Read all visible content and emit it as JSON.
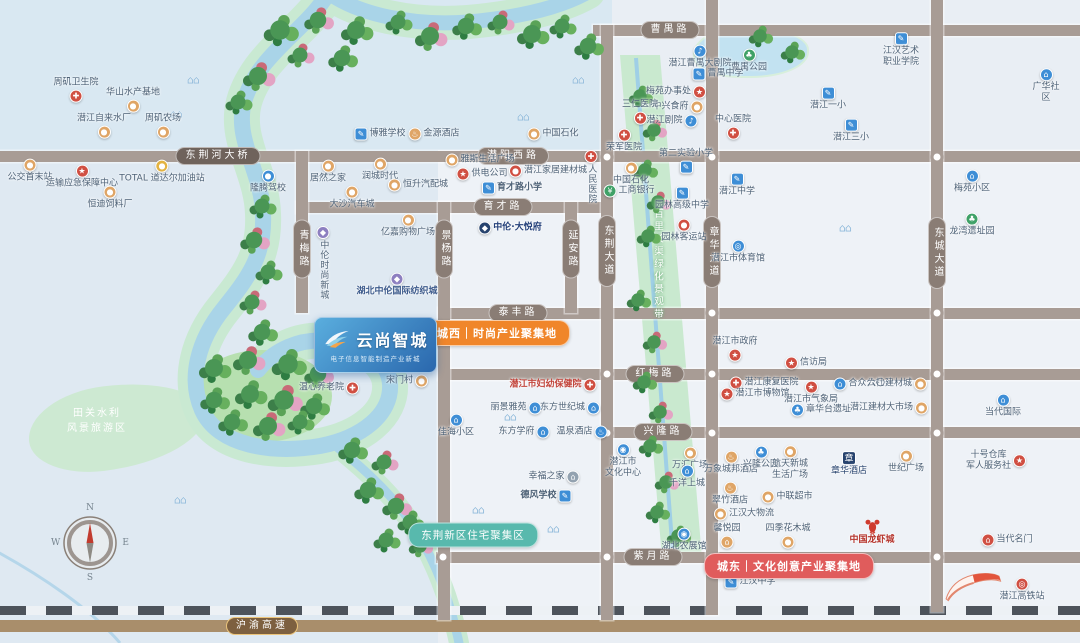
{
  "map": {
    "project": {
      "name": "云尚智城",
      "tagline": "电子信息智能制造产业新城"
    },
    "banners": {
      "west": "城西｜时尚产业聚集地",
      "east": "城东｜文化创意产业聚集地",
      "residential": "东荆新区住宅聚集区"
    },
    "areas": {
      "scenic": "田关水利\n风景旅游区",
      "greenway": "百里长渠绿化景观带"
    },
    "compass": {
      "n": "N",
      "e": "E",
      "s": "S",
      "w": "W"
    },
    "colors": {
      "ground": "#e9eef4",
      "water": "#d9e8f2",
      "block": "#eef2f7",
      "road": "#a89c95",
      "capsule": "#8a7d75",
      "river": "#a9d4e8",
      "greenway": "#c9e9cf",
      "west": "#f0862a",
      "east": "#e05c5c",
      "residential": "#58b9ad",
      "rail_dark": "#4d535b",
      "highway": "#a98e6b",
      "highway_capsule": "#7d6040",
      "gold": "#ecc57c"
    },
    "roads_h": [
      {
        "name": "曹禺路",
        "y": 25,
        "x1": 593,
        "x2": 1080,
        "lx": 670
      },
      {
        "name": "潜阳西路",
        "y": 151,
        "x1": 0,
        "x2": 1080,
        "lx": 513
      },
      {
        "name": "育才路",
        "y": 202,
        "x1": 296,
        "x2": 612,
        "lx": 503
      },
      {
        "name": "泰丰路",
        "y": 308,
        "x1": 438,
        "x2": 1080,
        "lx": 518
      },
      {
        "name": "红梅路",
        "y": 369,
        "x1": 438,
        "x2": 1080,
        "lx": 655
      },
      {
        "name": "兴隆路",
        "y": 427,
        "x1": 600,
        "x2": 1080,
        "lx": 663
      },
      {
        "name": "紫月路",
        "y": 552,
        "x1": 436,
        "x2": 1080,
        "lx": 653
      }
    ],
    "roads_v": [
      {
        "name": "青梅路",
        "x": 296,
        "y1": 151,
        "y2": 313,
        "ly": 249
      },
      {
        "name": "景杨路",
        "x": 438,
        "y1": 202,
        "y2": 620,
        "ly": 249
      },
      {
        "name": "延安路",
        "x": 565,
        "y1": 202,
        "y2": 313,
        "ly": 249
      },
      {
        "name": "东荆大道",
        "x": 601,
        "y1": 25,
        "y2": 620,
        "ly": 251
      },
      {
        "name": "章华大道",
        "x": 706,
        "y1": 0,
        "y2": 615,
        "ly": 252
      },
      {
        "name": "东城大道",
        "x": 931,
        "y1": 0,
        "y2": 612,
        "ly": 253
      }
    ],
    "extra_labels": [
      {
        "text": "东荆河大桥",
        "x": 218,
        "y": 156,
        "cls": "bridge"
      }
    ],
    "highway": {
      "name": "沪渝高速",
      "lx": 262,
      "ly": 626
    },
    "nodes": [
      [
        607,
        157
      ],
      [
        712,
        157
      ],
      [
        937,
        157
      ],
      [
        712,
        313
      ],
      [
        937,
        313
      ],
      [
        607,
        374
      ],
      [
        712,
        374
      ],
      [
        937,
        374
      ],
      [
        607,
        433
      ],
      [
        712,
        433
      ],
      [
        937,
        433
      ],
      [
        443,
        557
      ],
      [
        607,
        557
      ],
      [
        712,
        557
      ],
      [
        937,
        557
      ]
    ],
    "pois": [
      {
        "label": "周矶卫生院",
        "x": 76,
        "y": 90,
        "ic": "hospital",
        "c": "red",
        "ip": "bottom"
      },
      {
        "label": "华山水产基地",
        "x": 133,
        "y": 100,
        "ic": "shop",
        "c": "orange",
        "ip": "bottom"
      },
      {
        "label": "潜江自来水厂",
        "x": 104,
        "y": 126,
        "ic": "shop",
        "c": "orange",
        "ip": "bottom"
      },
      {
        "label": "周矶农场",
        "x": 163,
        "y": 126,
        "ic": "shop",
        "c": "orange",
        "ip": "bottom"
      },
      {
        "label": "公交首末站",
        "x": 30,
        "y": 171,
        "ic": "bus",
        "c": "orange",
        "ip": "top"
      },
      {
        "label": "运输应急保障中心",
        "x": 82,
        "y": 177,
        "ic": "gov",
        "c": "red",
        "ip": "top"
      },
      {
        "label": "恒迪饲料厂",
        "x": 110,
        "y": 198,
        "ic": "shop",
        "c": "orange",
        "ip": "top"
      },
      {
        "label": "TOTAL 道达尔加油站",
        "x": 162,
        "y": 172,
        "ic": "fuel",
        "c": "gold",
        "ip": "top"
      },
      {
        "label": "隆腾驾校",
        "x": 268,
        "y": 182,
        "ic": "car",
        "c": "blue",
        "ip": "top"
      },
      {
        "label": "博雅学校",
        "x": 380,
        "y": 134,
        "ic": "school",
        "c": "blue",
        "ip": "left"
      },
      {
        "label": "金源酒店",
        "x": 434,
        "y": 134,
        "ic": "hotel",
        "c": "orange",
        "ip": "left"
      },
      {
        "label": "中国石化",
        "x": 553,
        "y": 134,
        "ic": "fuel",
        "c": "orange",
        "ip": "left"
      },
      {
        "label": "居然之家",
        "x": 328,
        "y": 172,
        "ic": "shop",
        "c": "orange",
        "ip": "top"
      },
      {
        "label": "润城时代",
        "x": 380,
        "y": 170,
        "ic": "shop",
        "c": "orange",
        "ip": "top"
      },
      {
        "label": "恒升汽配城",
        "x": 418,
        "y": 185,
        "ic": "shop",
        "c": "orange",
        "ip": "left"
      },
      {
        "label": "大沙汽车城",
        "x": 352,
        "y": 198,
        "ic": "shop",
        "c": "orange",
        "ip": "top"
      },
      {
        "label": "雅斯生活广场",
        "x": 480,
        "y": 160,
        "ic": "shop",
        "c": "orange",
        "ip": "left"
      },
      {
        "label": "供电公司",
        "x": 482,
        "y": 174,
        "ic": "gov",
        "c": "red",
        "ip": "left"
      },
      {
        "label": "潜江家居建材城",
        "x": 548,
        "y": 171,
        "ic": "shop",
        "c": "red",
        "ip": "left"
      },
      {
        "label": "育才路小学",
        "x": 512,
        "y": 188,
        "ic": "school",
        "c": "blue",
        "ip": "left",
        "bold": true
      },
      {
        "label": "人民医院",
        "x": 591,
        "y": 177,
        "ic": "hospital",
        "c": "red",
        "ip": "top",
        "v": true
      },
      {
        "label": "中国石化",
        "x": 631,
        "y": 174,
        "ic": "fuel",
        "c": "orange",
        "ip": "top"
      },
      {
        "label": "工商银行",
        "x": 629,
        "y": 191,
        "ic": "bank",
        "c": "green",
        "ip": "left"
      },
      {
        "label": "中伦时尚新城",
        "x": 323,
        "y": 263,
        "ic": "brand",
        "c": "purple",
        "ip": "top",
        "v": true
      },
      {
        "label": "亿嘉购物广场",
        "x": 408,
        "y": 226,
        "ic": "shop",
        "c": "orange",
        "ip": "top"
      },
      {
        "label": "湖北中伦国际纺织城",
        "x": 397,
        "y": 285,
        "ic": "brand",
        "c": "purple",
        "ip": "top",
        "bold": true,
        "lc": "#3d5b8c"
      },
      {
        "label": "中伦·大悦府",
        "x": 510,
        "y": 228,
        "ic": "brandmark",
        "c": "navy",
        "ip": "left",
        "lc": "#24407a",
        "bold": true
      },
      {
        "label": "温心养老院",
        "x": 329,
        "y": 388,
        "ic": "hospital",
        "c": "red",
        "ip": "right"
      },
      {
        "label": "宋门村",
        "x": 407,
        "y": 381,
        "ic": "shop",
        "c": "orange",
        "ip": "right"
      },
      {
        "label": "潜江曹禺大剧院",
        "x": 700,
        "y": 57,
        "ic": "theater",
        "c": "blue",
        "ip": "top"
      },
      {
        "label": "曹禺公园",
        "x": 749,
        "y": 61,
        "ic": "park",
        "c": "green",
        "ip": "top"
      },
      {
        "label": "曹禺中学",
        "x": 718,
        "y": 74,
        "ic": "school",
        "c": "blue",
        "ip": "left"
      },
      {
        "label": "梅苑办事处",
        "x": 676,
        "y": 92,
        "ic": "gov",
        "c": "red",
        "ip": "right"
      },
      {
        "label": "中兴食府",
        "x": 678,
        "y": 107,
        "ic": "shop",
        "c": "orange",
        "ip": "right"
      },
      {
        "label": "潜江剧院",
        "x": 672,
        "y": 121,
        "ic": "theater",
        "c": "blue",
        "ip": "right"
      },
      {
        "label": "三仁医院",
        "x": 640,
        "y": 112,
        "ic": "hospital",
        "c": "red",
        "ip": "bottom"
      },
      {
        "label": "荣军医院",
        "x": 624,
        "y": 141,
        "ic": "hospital",
        "c": "red",
        "ip": "top"
      },
      {
        "label": "江汉艺术\n职业学院",
        "x": 901,
        "y": 50,
        "ic": "school",
        "c": "blue",
        "ip": "top"
      },
      {
        "label": "潜江一小",
        "x": 828,
        "y": 99,
        "ic": "school",
        "c": "blue",
        "ip": "top"
      },
      {
        "label": "潜江三小",
        "x": 851,
        "y": 131,
        "ic": "school",
        "c": "blue",
        "ip": "top"
      },
      {
        "label": "中心医院",
        "x": 733,
        "y": 127,
        "ic": "hospital",
        "c": "red",
        "ip": "bottom"
      },
      {
        "label": "广华社区",
        "x": 1046,
        "y": 86,
        "ic": "home",
        "c": "blue",
        "ip": "top"
      },
      {
        "label": "梅苑小区",
        "x": 972,
        "y": 182,
        "ic": "home",
        "c": "blue",
        "ip": "top"
      },
      {
        "label": "龙湾遗址园",
        "x": 972,
        "y": 225,
        "ic": "park",
        "c": "green",
        "ip": "top"
      },
      {
        "label": "第二实验小学",
        "x": 686,
        "y": 161,
        "ic": "school",
        "c": "blue",
        "ip": "bottom"
      },
      {
        "label": "潜江中学",
        "x": 737,
        "y": 185,
        "ic": "school",
        "c": "blue",
        "ip": "top"
      },
      {
        "label": "园林高级中学",
        "x": 682,
        "y": 199,
        "ic": "school",
        "c": "blue",
        "ip": "top"
      },
      {
        "label": "园林客运站",
        "x": 684,
        "y": 231,
        "ic": "bus",
        "c": "red",
        "ip": "top"
      },
      {
        "label": "潜江市体育馆",
        "x": 738,
        "y": 252,
        "ic": "stadium",
        "c": "blue",
        "ip": "top"
      },
      {
        "label": "潜江市政府",
        "x": 735,
        "y": 349,
        "ic": "gov",
        "c": "red",
        "ip": "bottom"
      },
      {
        "label": "信访局",
        "x": 806,
        "y": 363,
        "ic": "gov",
        "c": "red",
        "ip": "left"
      },
      {
        "label": "潜江康复医院",
        "x": 764,
        "y": 383,
        "ic": "hospital",
        "c": "red",
        "ip": "left"
      },
      {
        "label": "潜江市博物馆",
        "x": 755,
        "y": 394,
        "ic": "gov",
        "c": "red",
        "ip": "left"
      },
      {
        "label": "潜江市气象局",
        "x": 811,
        "y": 393,
        "ic": "gov",
        "c": "red",
        "ip": "top"
      },
      {
        "label": "合众公社",
        "x": 859,
        "y": 384,
        "ic": "home",
        "c": "blue",
        "ip": "left"
      },
      {
        "label": "六〇建材城",
        "x": 897,
        "y": 384,
        "ic": "shop",
        "c": "orange",
        "ip": "right"
      },
      {
        "label": "章华台遗址",
        "x": 821,
        "y": 410,
        "ic": "park",
        "c": "blue",
        "ip": "left"
      },
      {
        "label": "潜江建材大市场",
        "x": 889,
        "y": 408,
        "ic": "shop",
        "c": "orange",
        "ip": "right"
      },
      {
        "label": "潜江市妇幼保健院",
        "x": 553,
        "y": 385,
        "ic": "hospital",
        "c": "red",
        "ip": "right",
        "bold": true,
        "lc": "#c2453c"
      },
      {
        "label": "丽景雅苑",
        "x": 516,
        "y": 408,
        "ic": "home",
        "c": "blue",
        "ip": "right"
      },
      {
        "label": "东方世纪城",
        "x": 570,
        "y": 408,
        "ic": "home",
        "c": "blue",
        "ip": "right"
      },
      {
        "label": "佳海小区",
        "x": 456,
        "y": 426,
        "ic": "home",
        "c": "blue",
        "ip": "top"
      },
      {
        "label": "东方学府",
        "x": 524,
        "y": 432,
        "ic": "home",
        "c": "blue",
        "ip": "right"
      },
      {
        "label": "温泉酒店",
        "x": 582,
        "y": 432,
        "ic": "hotel",
        "c": "blue",
        "ip": "right"
      },
      {
        "label": "潜江市\n文化中心",
        "x": 623,
        "y": 461,
        "ic": "culture",
        "c": "blue",
        "ip": "top"
      },
      {
        "label": "幸福之家",
        "x": 554,
        "y": 477,
        "ic": "home",
        "c": "gray",
        "ip": "right"
      },
      {
        "label": "德风学校",
        "x": 546,
        "y": 496,
        "ic": "school",
        "c": "blue",
        "ip": "right",
        "bold": true
      },
      {
        "label": "万汇广场",
        "x": 690,
        "y": 459,
        "ic": "shop",
        "c": "orange",
        "ip": "top"
      },
      {
        "label": "千洋上城",
        "x": 687,
        "y": 477,
        "ic": "home",
        "c": "blue",
        "ip": "top"
      },
      {
        "label": "万象城邦酒店",
        "x": 731,
        "y": 463,
        "ic": "hotel",
        "c": "orange",
        "ip": "top"
      },
      {
        "label": "兴隆公园",
        "x": 761,
        "y": 458,
        "ic": "park",
        "c": "blue",
        "ip": "top"
      },
      {
        "label": "航天新城\n生活广场",
        "x": 790,
        "y": 463,
        "ic": "shop",
        "c": "orange",
        "ip": "top"
      },
      {
        "label": "章华酒店",
        "x": 849,
        "y": 464,
        "ic": "seal",
        "c": "navy",
        "ip": "top",
        "lc": "#27436e"
      },
      {
        "label": "世纪广场",
        "x": 906,
        "y": 462,
        "ic": "shop",
        "c": "orange",
        "ip": "top"
      },
      {
        "label": "翠竹酒店",
        "x": 730,
        "y": 494,
        "ic": "hotel",
        "c": "orange",
        "ip": "top"
      },
      {
        "label": "中联超市",
        "x": 787,
        "y": 497,
        "ic": "shop",
        "c": "orange",
        "ip": "left"
      },
      {
        "label": "江汉大物流",
        "x": 744,
        "y": 514,
        "ic": "shop",
        "c": "orange",
        "ip": "left"
      },
      {
        "label": "中国龙虾城",
        "x": 872,
        "y": 532,
        "ic": "lobster",
        "ip": "top",
        "lc": "#b5342c",
        "bold": true
      },
      {
        "label": "湖北农展馆",
        "x": 684,
        "y": 540,
        "ic": "culture",
        "c": "blue",
        "ip": "top"
      },
      {
        "label": "馨悦园",
        "x": 727,
        "y": 536,
        "ic": "home",
        "c": "orange",
        "ip": "bottom"
      },
      {
        "label": "四季花木城",
        "x": 788,
        "y": 536,
        "ic": "shop",
        "c": "orange",
        "ip": "bottom"
      },
      {
        "label": "江汉中学",
        "x": 750,
        "y": 582,
        "ic": "school",
        "c": "blue",
        "ip": "left"
      },
      {
        "label": "当代名门",
        "x": 1007,
        "y": 540,
        "ic": "home",
        "c": "red",
        "ip": "left"
      },
      {
        "label": "十号仓库\n军人服务社",
        "x": 996,
        "y": 461,
        "ic": "gov",
        "c": "red",
        "ip": "right"
      },
      {
        "label": "当代国际",
        "x": 1003,
        "y": 406,
        "ic": "home",
        "c": "blue",
        "ip": "top"
      },
      {
        "label": "潜江高铁站",
        "x": 1022,
        "y": 590,
        "ic": "rail",
        "c": "red",
        "ip": "top"
      }
    ],
    "trees": [
      [
        280,
        30,
        1.3,
        0
      ],
      [
        318,
        20,
        1.1,
        1
      ],
      [
        356,
        30,
        1.2,
        0
      ],
      [
        398,
        22,
        1.0,
        0
      ],
      [
        430,
        36,
        1.2,
        1
      ],
      [
        466,
        26,
        1.1,
        0
      ],
      [
        500,
        22,
        1.0,
        1
      ],
      [
        532,
        34,
        1.2,
        0
      ],
      [
        562,
        26,
        1.0,
        0
      ],
      [
        588,
        46,
        1.1,
        0
      ],
      [
        300,
        55,
        1.0,
        1
      ],
      [
        342,
        58,
        1.1,
        0
      ],
      [
        258,
        76,
        1.2,
        1
      ],
      [
        238,
        102,
        1.0,
        0
      ],
      [
        262,
        206,
        1.0,
        0
      ],
      [
        254,
        240,
        1.1,
        1
      ],
      [
        268,
        272,
        1.0,
        0
      ],
      [
        252,
        302,
        1.0,
        1
      ],
      [
        262,
        332,
        1.1,
        0
      ],
      [
        214,
        368,
        1.2,
        0
      ],
      [
        248,
        360,
        1.2,
        1
      ],
      [
        288,
        364,
        1.3,
        0
      ],
      [
        318,
        374,
        1.1,
        1
      ],
      [
        214,
        400,
        1.1,
        0
      ],
      [
        250,
        394,
        1.2,
        0
      ],
      [
        284,
        400,
        1.3,
        1
      ],
      [
        314,
        406,
        1.1,
        0
      ],
      [
        232,
        422,
        1.1,
        0
      ],
      [
        268,
        426,
        1.2,
        1
      ],
      [
        300,
        422,
        1.0,
        0
      ],
      [
        352,
        450,
        1.1,
        0
      ],
      [
        384,
        462,
        1.0,
        1
      ],
      [
        368,
        490,
        1.1,
        0
      ],
      [
        396,
        506,
        1.1,
        1
      ],
      [
        410,
        522,
        1.0,
        0
      ],
      [
        386,
        540,
        1.0,
        0
      ],
      [
        420,
        546,
        0.9,
        1
      ],
      [
        640,
        96,
        0.9,
        0
      ],
      [
        654,
        130,
        0.9,
        1
      ],
      [
        645,
        170,
        0.9,
        0
      ],
      [
        658,
        202,
        0.9,
        1
      ],
      [
        648,
        236,
        0.9,
        0
      ],
      [
        638,
        300,
        0.9,
        0
      ],
      [
        654,
        342,
        0.9,
        1
      ],
      [
        644,
        382,
        0.9,
        0
      ],
      [
        660,
        412,
        0.9,
        1
      ],
      [
        650,
        446,
        0.9,
        0
      ],
      [
        666,
        482,
        0.9,
        1
      ],
      [
        657,
        512,
        0.9,
        0
      ],
      [
        678,
        536,
        0.9,
        0
      ],
      [
        760,
        36,
        0.9,
        0
      ],
      [
        792,
        52,
        0.9,
        0
      ]
    ],
    "decor": [
      [
        193,
        80
      ],
      [
        176,
        114
      ],
      [
        578,
        80
      ],
      [
        523,
        117
      ],
      [
        845,
        228
      ],
      [
        510,
        417
      ],
      [
        478,
        510
      ],
      [
        553,
        529
      ],
      [
        457,
        543
      ],
      [
        180,
        500
      ]
    ]
  }
}
